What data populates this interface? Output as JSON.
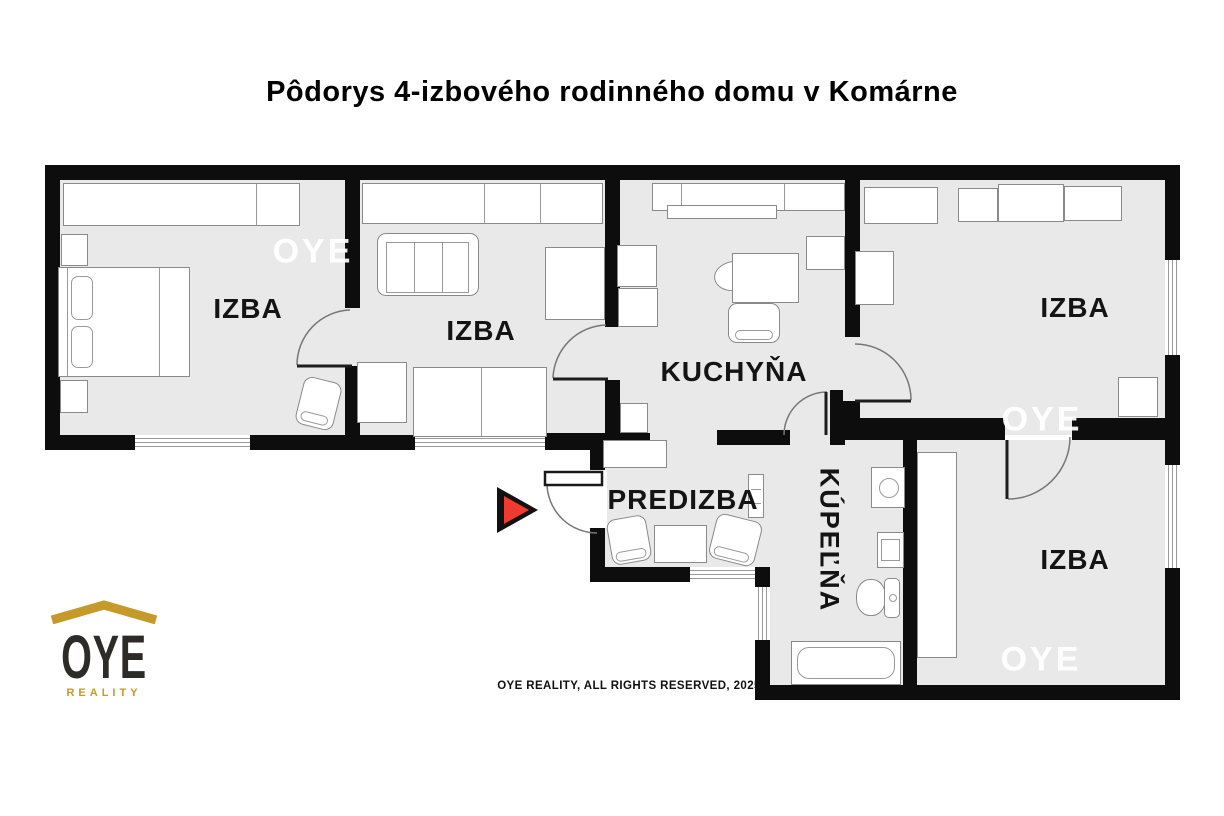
{
  "title": "Pôdorys 4-izbového rodinného domu v Komárne",
  "footer": "OYE REALITY, ALL RIGHTS RESERVED, 2025",
  "watermark": "OYE",
  "logo": {
    "name": "OYE",
    "tagline": "REALITY"
  },
  "rooms": [
    {
      "id": "izba-1",
      "label": "IZBA"
    },
    {
      "id": "izba-2",
      "label": "IZBA"
    },
    {
      "id": "kuchyna",
      "label": "KUCHYŇA"
    },
    {
      "id": "izba-3",
      "label": "IZBA"
    },
    {
      "id": "predizba",
      "label": "PREDIZBA"
    },
    {
      "id": "kupelna",
      "label": "KÚPEĽŇA"
    },
    {
      "id": "izba-4",
      "label": "IZBA"
    }
  ],
  "colors": {
    "wall": "#0d0d0d",
    "floor": "#e9e9e9",
    "entrance_arrow_red": "#ee3a2f",
    "logo_gold": "#c6992b",
    "watermark_white": "#ffffff"
  }
}
